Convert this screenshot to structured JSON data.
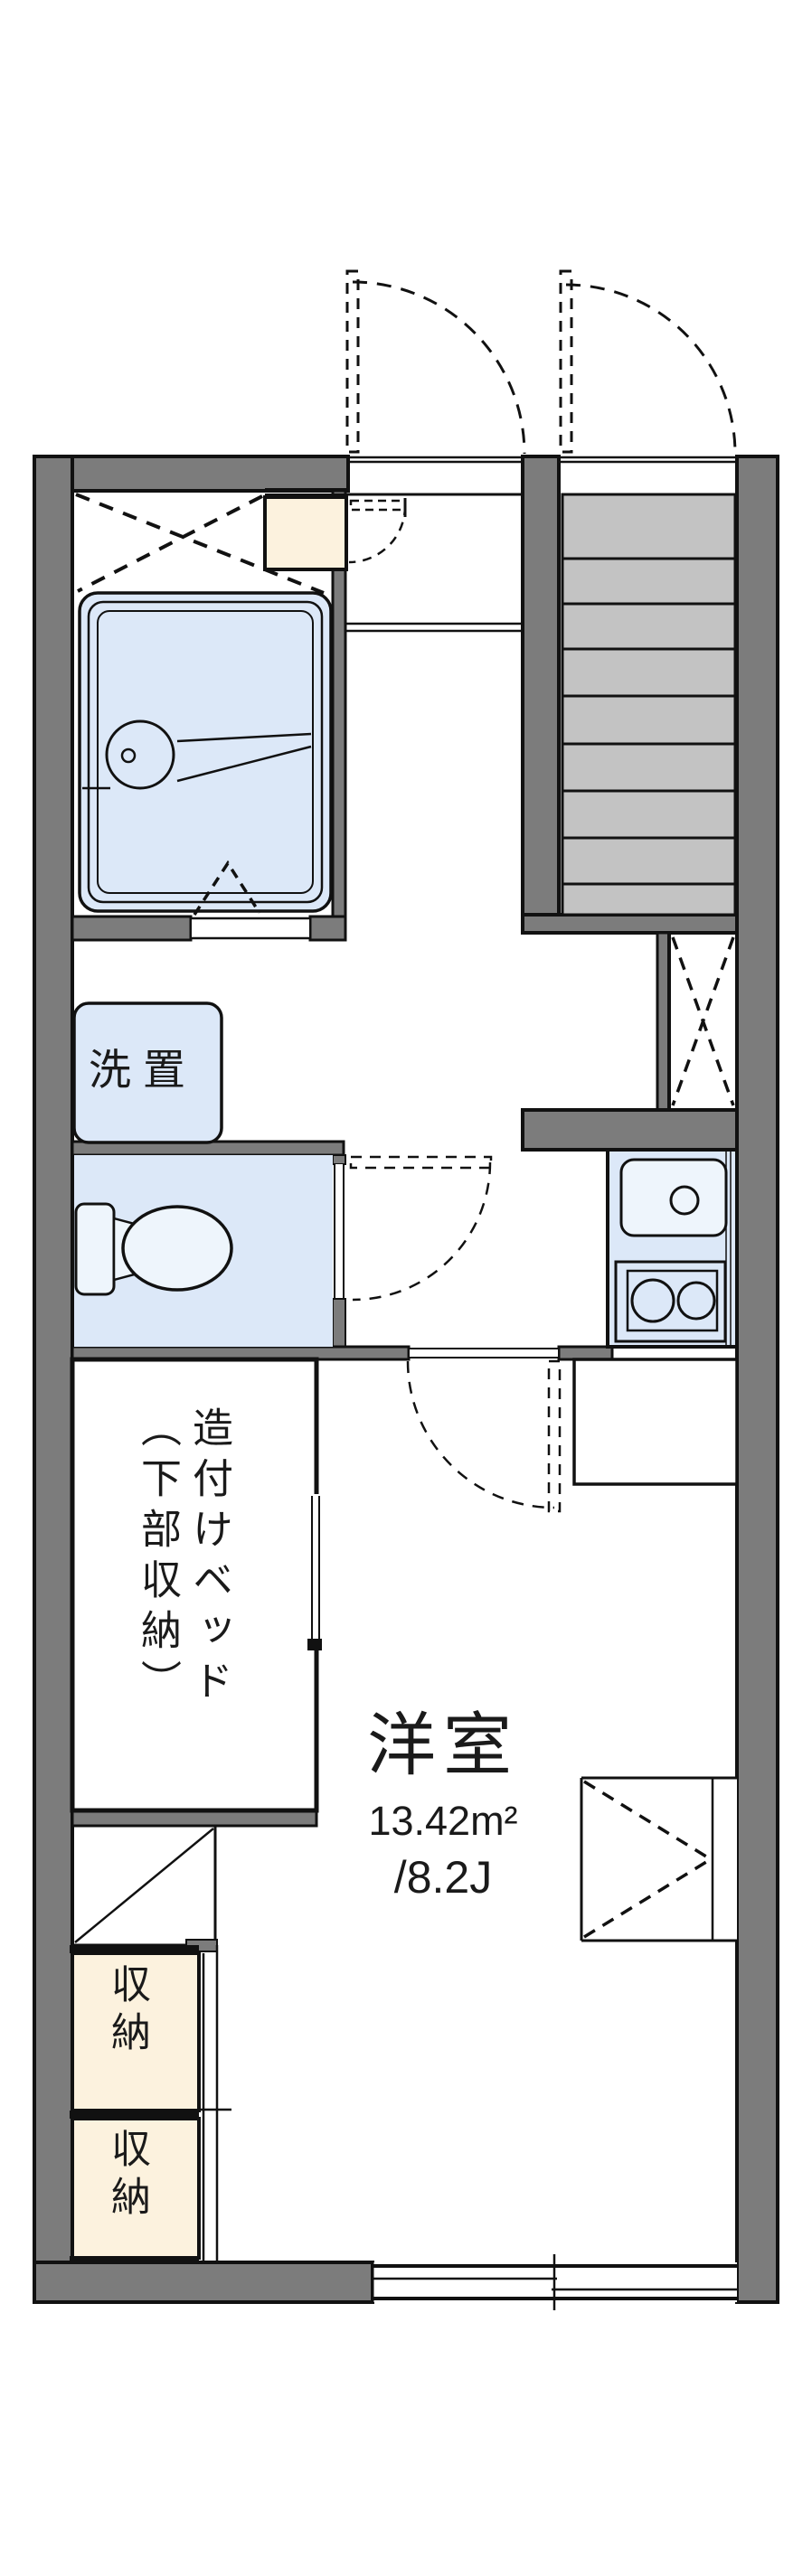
{
  "room": {
    "name": "洋室",
    "area_sqm": "13.42m²",
    "area_tatami": "/8.2J"
  },
  "labels": {
    "washing_machine": "洗置",
    "built_in_bed": {
      "line1": "造付けベッド",
      "line2": "（下部収納）"
    },
    "closet_upper": "収納",
    "closet_lower": "収納"
  },
  "colors": {
    "wall_fill": "#7c7c7c",
    "stair_tread": "#c3c3c3",
    "fixture_blue": "#dce8f8",
    "fixture_inner": "#eef5fc",
    "storage_cream": "#fcf2de",
    "outline": "#111111",
    "background": "#ffffff"
  }
}
